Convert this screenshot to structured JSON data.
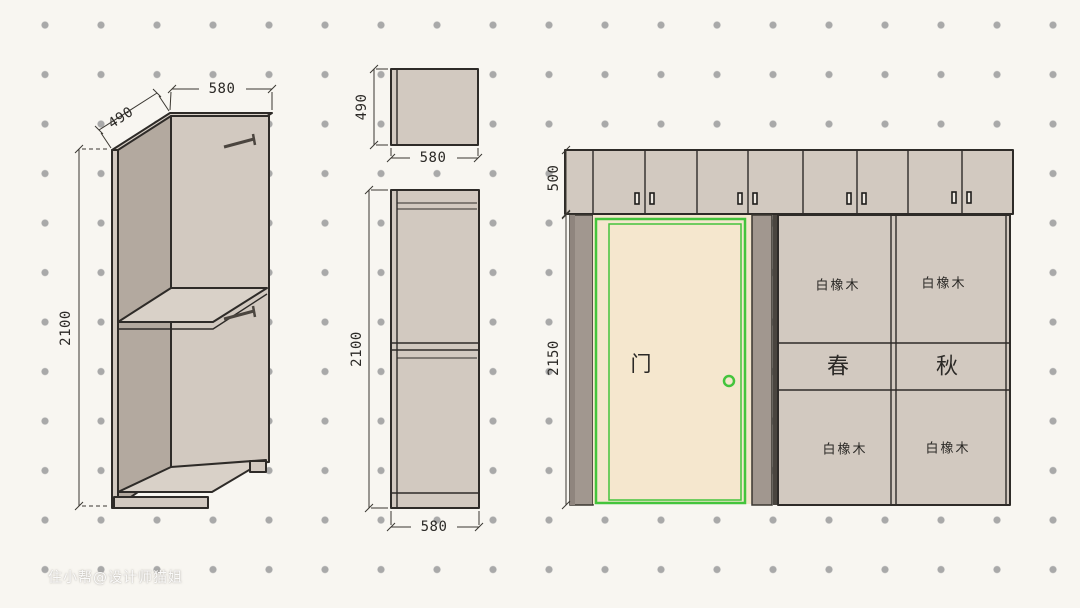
{
  "watermark": {
    "text": "住小帮@设计师猫姐"
  },
  "colors": {
    "background": "#f8f6f1",
    "grid_dot": "#a9a9a9",
    "line": "#2e2b28",
    "panel": "#d2c9c0",
    "panel_light": "#d9d1c8",
    "panel_dark": "#b3a99f",
    "column_dark": "#a1978f",
    "column_darker": "#8f857e",
    "door_fill": "#f5e7ce",
    "accent_green": "#44c43c"
  },
  "iso_view": {
    "dim_depth": "490",
    "dim_width": "580",
    "dim_height": "2100"
  },
  "top_view": {
    "dim_depth": "490",
    "dim_width": "580"
  },
  "front_view": {
    "dim_height": "2100",
    "dim_width": "580"
  },
  "elevation": {
    "dim_upper_height": "500",
    "dim_lower_height": "2150",
    "door": {
      "label": "门"
    },
    "panels": {
      "top_left": "白橡木",
      "top_right": "白橡木",
      "mid_left": "春",
      "mid_right": "秋",
      "bottom_left": "白橡木",
      "bottom_right": "白橡木"
    }
  }
}
